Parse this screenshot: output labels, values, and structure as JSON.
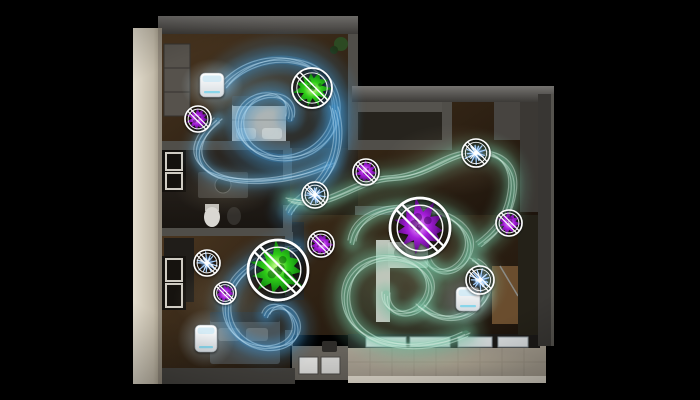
{
  "scene": {
    "description": "top-down-3d-apartment-floorplan-with-air-purification-airflow-visualization",
    "background": "#000000",
    "palette": {
      "airflow_blue": "#3f93cc",
      "airflow_blue_light": "#bfe2f7",
      "airflow_teal": "#6fbf9f",
      "airflow_teal_light": "#d6f0e3",
      "virus_green": "#2ecc17",
      "virus_purple": "#a61ddb",
      "allergen_blue": "#7db9f7",
      "badge_ring": "#ffffff",
      "wall_light": "#d9d2c3",
      "wall_dark": "#55534e",
      "wood_floor": "#3a2a18",
      "balcony_tile": "#a59d8f"
    }
  },
  "devices": [
    {
      "id": "air-purifier-bedroom",
      "x": 200,
      "y": 73,
      "w": 24,
      "h": 24
    },
    {
      "id": "air-purifier-bedroom2",
      "x": 195,
      "y": 325,
      "w": 22,
      "h": 27
    },
    {
      "id": "air-purifier-living",
      "x": 456,
      "y": 287,
      "w": 24,
      "h": 24
    }
  ],
  "badges": [
    {
      "id": "badge-virus-green-top",
      "type": "virus-green",
      "x": 312,
      "y": 88,
      "r": 20,
      "seed": 3
    },
    {
      "id": "badge-virus-purple-1",
      "type": "virus-purple",
      "x": 198,
      "y": 119,
      "r": 13,
      "seed": 7
    },
    {
      "id": "badge-allergen-blue-1",
      "type": "allergen-blue",
      "x": 476,
      "y": 153,
      "r": 14,
      "seed": 11
    },
    {
      "id": "badge-virus-purple-2",
      "type": "virus-purple",
      "x": 366,
      "y": 172,
      "r": 13,
      "seed": 5
    },
    {
      "id": "badge-allergen-blue-2",
      "type": "allergen-blue",
      "x": 315,
      "y": 195,
      "r": 13,
      "seed": 13
    },
    {
      "id": "badge-virus-purple-large",
      "type": "virus-purple",
      "x": 420,
      "y": 228,
      "r": 30,
      "seed": 17
    },
    {
      "id": "badge-virus-purple-3",
      "type": "virus-purple",
      "x": 509,
      "y": 223,
      "r": 13,
      "seed": 19
    },
    {
      "id": "badge-allergen-blue-3",
      "type": "allergen-blue",
      "x": 207,
      "y": 263,
      "r": 13,
      "seed": 23
    },
    {
      "id": "badge-virus-purple-4",
      "type": "virus-purple",
      "x": 225,
      "y": 293,
      "r": 11,
      "seed": 29
    },
    {
      "id": "badge-virus-green-large",
      "type": "virus-green",
      "x": 278,
      "y": 270,
      "r": 30,
      "seed": 31
    },
    {
      "id": "badge-virus-purple-5",
      "type": "virus-purple",
      "x": 321,
      "y": 244,
      "r": 13,
      "seed": 37
    },
    {
      "id": "badge-allergen-blue-4",
      "type": "allergen-blue",
      "x": 480,
      "y": 280,
      "r": 14,
      "seed": 41
    }
  ],
  "airflow_streams": [
    {
      "id": "stream-bedroom-spiral",
      "color": "#3f93cc",
      "hi": "#bfe2f7",
      "width": 28,
      "d": "M 225 85 C 258 46 330 52 336 104 C 340 148 290 170 258 152 C 232 138 234 104 262 96 C 282 91 294 104 290 118"
    },
    {
      "id": "stream-bath-sweep",
      "color": "#57a2cf",
      "hi": "#cfe8f8",
      "width": 16,
      "d": "M 218 120 C 196 138 190 158 210 172 C 232 186 290 184 330 164"
    },
    {
      "id": "stream-hall-drop",
      "color": "#3f93cc",
      "hi": "#bfe2f7",
      "width": 24,
      "d": "M 334 108 C 344 142 334 172 312 190 C 300 200 292 206 290 212"
    },
    {
      "id": "stream-mid-wave",
      "color": "#6fbf9f",
      "hi": "#d6f0e3",
      "width": 20,
      "d": "M 290 200 C 330 212 352 180 392 178 C 430 176 445 153 477 152 C 504 152 516 170 512 194 C 508 220 494 234 480 244"
    },
    {
      "id": "stream-purple-loop",
      "color": "#6fbf9f",
      "hi": "#d6f0e3",
      "width": 20,
      "d": "M 352 242 C 356 216 386 204 420 208 C 458 213 478 236 466 258 C 456 276 432 276 426 258"
    },
    {
      "id": "stream-living-spiral",
      "color": "#6fbf9f",
      "hi": "#d6f0e3",
      "width": 24,
      "d": "M 466 334 C 420 356 360 348 348 312 C 338 280 362 254 396 258 C 428 262 440 288 422 306 C 407 320 384 313 386 294"
    },
    {
      "id": "stream-device-loop",
      "color": "#79c2a6",
      "hi": "#d6f0e3",
      "width": 16,
      "d": "M 420 306 C 438 322 462 322 478 306 C 494 290 490 268 474 260"
    },
    {
      "id": "stream-bedroom2-spiral",
      "color": "#3f93cc",
      "hi": "#bfe2f7",
      "width": 22,
      "d": "M 296 248 C 268 252 234 270 228 298 C 222 326 240 346 266 348 C 290 349 302 334 294 318 C 287 303 270 303 266 315"
    }
  ]
}
